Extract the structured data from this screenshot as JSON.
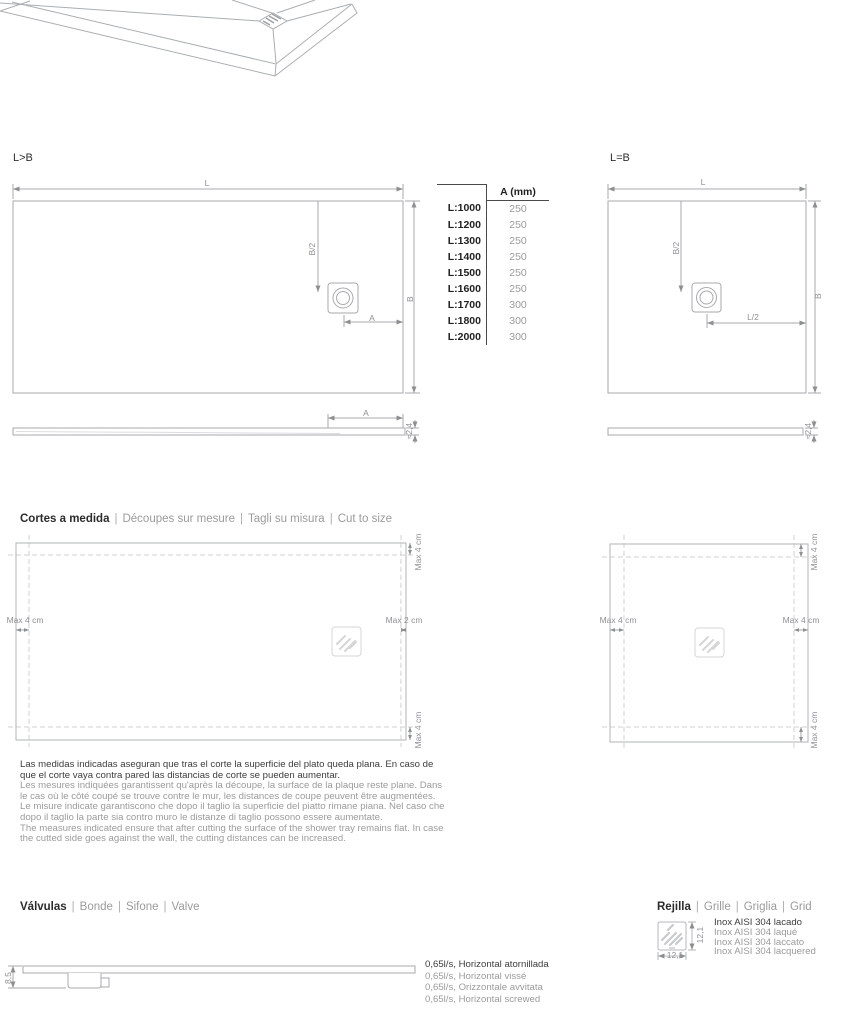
{
  "plan_left": {
    "label": "L>B",
    "dim_l": "L",
    "dim_b": "B",
    "dim_b2": "B/2",
    "dim_a": "A"
  },
  "plan_right": {
    "label": "L=B",
    "dim_l": "L",
    "dim_b": "B",
    "dim_b2": "B/2",
    "dim_l2": "L/2"
  },
  "profile_left": {
    "dim_a": "A",
    "dim_thickness": "≈2,4"
  },
  "profile_right": {
    "dim_thickness": "≈2,4"
  },
  "size_table": {
    "header": "A (mm)",
    "rows": [
      {
        "l": "L:1000",
        "a": "250"
      },
      {
        "l": "L:1200",
        "a": "250"
      },
      {
        "l": "L:1300",
        "a": "250"
      },
      {
        "l": "L:1400",
        "a": "250"
      },
      {
        "l": "L:1500",
        "a": "250"
      },
      {
        "l": "L:1600",
        "a": "250"
      },
      {
        "l": "L:1700",
        "a": "300"
      },
      {
        "l": "L:1800",
        "a": "300"
      },
      {
        "l": "L:2000",
        "a": "300"
      }
    ]
  },
  "cut_section": {
    "title_es": "Cortes a medida",
    "title_fr": "Découpes sur mesure",
    "title_it": "Tagli su misura",
    "title_en": "Cut to size",
    "sep": "|",
    "left_diagram": {
      "max_left": "Max 4 cm",
      "max_right": "Max 2 cm",
      "max_top": "Max 4 cm",
      "max_bottom": "Max 4 cm"
    },
    "right_diagram": {
      "max_left": "Max 4 cm",
      "max_right": "Max 4 cm",
      "max_top": "Max 4 cm",
      "max_bottom": "Max 4 cm"
    },
    "note_es": "Las medidas indicadas aseguran que tras el corte la superficie del plato queda plana. En caso de que el corte vaya contra pared las distancias de corte se pueden aumentar.",
    "note_fr": "Les mesures indiquées garantissent qu'après la découpe, la surface de la plaque reste plane. Dans le cas où le côté coupé se trouve contre le mur, les distances de coupe peuvent être augmentées.",
    "note_it": "Le misure indicate garantiscono che dopo il taglio la superficie del piatto rimane piana. Nel caso che dopo il taglio la parte sia contro muro le distanze di taglio possono essere aumentate.",
    "note_en": "The measures indicated ensure that after cutting the surface of the shower tray remains flat. In case the cutted side goes against the wall, the cutting distances can be increased."
  },
  "valves_section": {
    "title_es": "Válvulas",
    "title_fr": "Bonde",
    "title_it": "Sifone",
    "title_en": "Valve",
    "sep": "|",
    "dim_height": "8,5",
    "specs": [
      "0,65l/s, Horizontal atornillada",
      "0,65l/s, Horizontal vissé",
      "0,65l/s, Orizzontale avvitata",
      "0,65l/s, Horizontal screwed"
    ]
  },
  "grid_section": {
    "title_es": "Rejilla",
    "title_fr": "Grille",
    "title_it": "Griglia",
    "title_en": "Grid",
    "sep": "|",
    "dim_w": "12,1",
    "dim_h": "12,1",
    "specs": [
      "Inox AISI 304 lacado",
      "Inox AISI 304 laqué",
      "Inox AISI 304 laccato",
      "Inox AISI 304 lacquered"
    ]
  }
}
